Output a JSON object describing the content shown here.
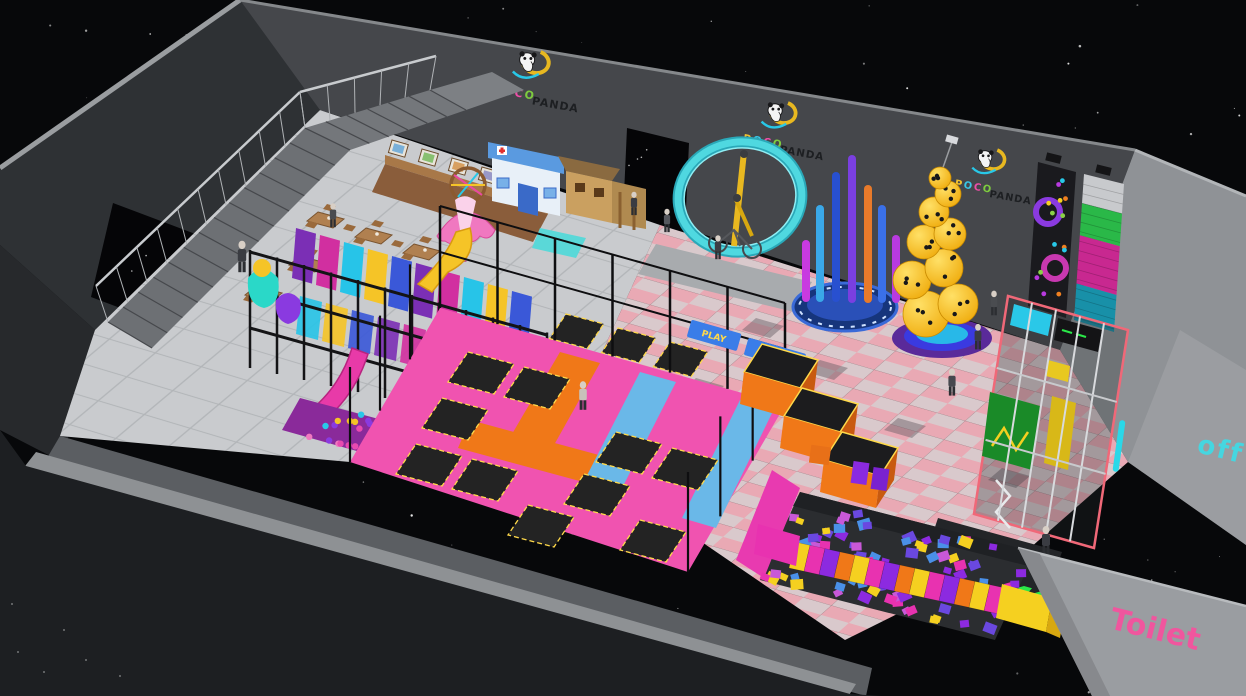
{
  "scene": {
    "description": "3D render of POCO PANDA indoor playground trampoline park",
    "brand": {
      "poco_letters": [
        {
          "ch": "P",
          "color": "#f2c230"
        },
        {
          "ch": "O",
          "color": "#38c8e8"
        },
        {
          "ch": "C",
          "color": "#ee4fa8"
        },
        {
          "ch": "O",
          "color": "#7ecb3f"
        }
      ],
      "panda_word": "PANDA",
      "panda_word_color": "#1d1f22"
    },
    "signs": {
      "office": {
        "text": "off",
        "color": "#45d6e0"
      },
      "toilet": {
        "text": "Toilet",
        "color": "#f0569e"
      },
      "climb_banner": {
        "text": "CLIMB",
        "color": "#ffd94a",
        "bg": "#3a7de8"
      },
      "play_banner": {
        "text": "PLAY",
        "color": "#ffd94a",
        "bg": "#3a7de8"
      }
    },
    "palette": {
      "background": "#07080a",
      "wall_back": "#45474b",
      "wall_left": "#2e3134",
      "wall_right": "#8f9296",
      "wall_front_outer": "#1d1f22",
      "wall_cap": "#8e9194",
      "floor_gray": "#c9cbce",
      "floor_checker_pink": "#e9a9b4",
      "floor_checker_light": "#d9c9cc",
      "trampoline_pink": "#f053b0",
      "trampoline_bed": "#232323",
      "bed_border_yellow": "#ffd94a",
      "lane_orange": "#f07818",
      "lane_blue": "#6ab8e8",
      "ring_cyan": "#4fd8e0",
      "duck_yellow": "#f8c81e",
      "foam_cubes": [
        "#e832b0",
        "#8c2ae0",
        "#f5d020",
        "#4a90e8",
        "#6a48e0",
        "#c858d8"
      ]
    }
  }
}
